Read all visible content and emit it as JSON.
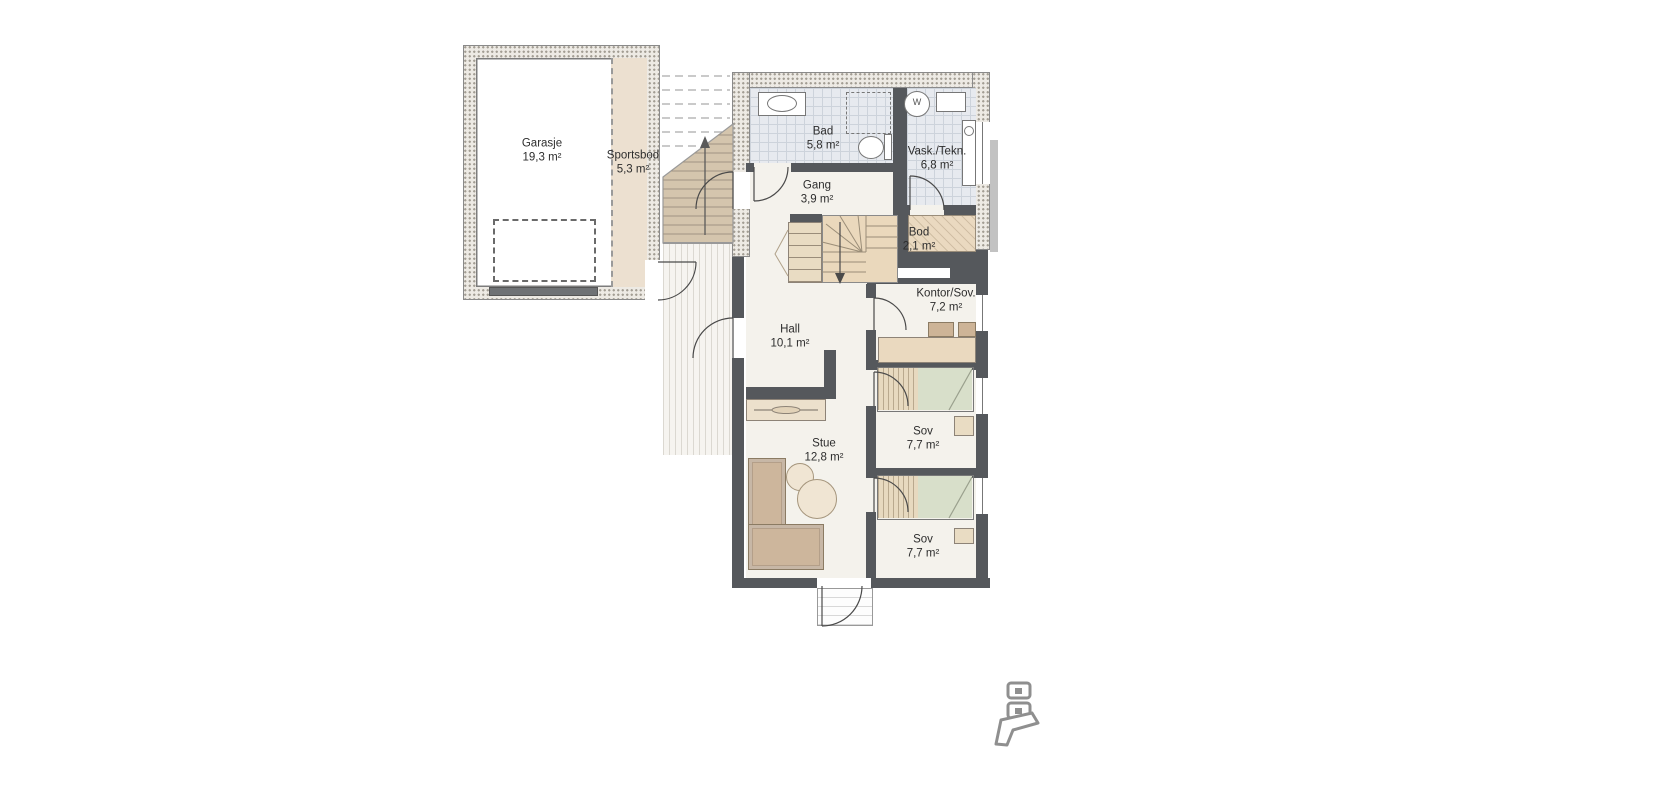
{
  "rooms": {
    "garasje": {
      "name": "Garasje",
      "area": "19,3 m²"
    },
    "sportsbod": {
      "name": "Sportsbod",
      "area": "5,3 m²"
    },
    "bad": {
      "name": "Bad",
      "area": "5,8 m²"
    },
    "vask_tekn": {
      "name": "Vask./Tekn.",
      "area": "6,8 m²"
    },
    "gang": {
      "name": "Gang",
      "area": "3,9 m²"
    },
    "bod": {
      "name": "Bod",
      "area": "2,1 m²"
    },
    "kontor_sov": {
      "name": "Kontor/Sov.",
      "area": "7,2 m²"
    },
    "hall": {
      "name": "Hall",
      "area": "10,1 m²"
    },
    "sov_1": {
      "name": "Sov",
      "area": "7,7 m²"
    },
    "stue": {
      "name": "Stue",
      "area": "12,8 m²"
    },
    "sov_2": {
      "name": "Sov",
      "area": "7,7 m²"
    }
  },
  "appliances": {
    "washing_machine_label": "W"
  },
  "colors": {
    "wall": "#55585c",
    "exterior_wall_fill": "#edeae4",
    "tile_floor": "#e7eaef",
    "interior_floor": "#f4f2ec",
    "wood_tan": "#e9dcc3",
    "furniture_tan": "#cdb69c",
    "bed_green": "#d8dfca",
    "logo_gray": "#8f8f8f"
  }
}
